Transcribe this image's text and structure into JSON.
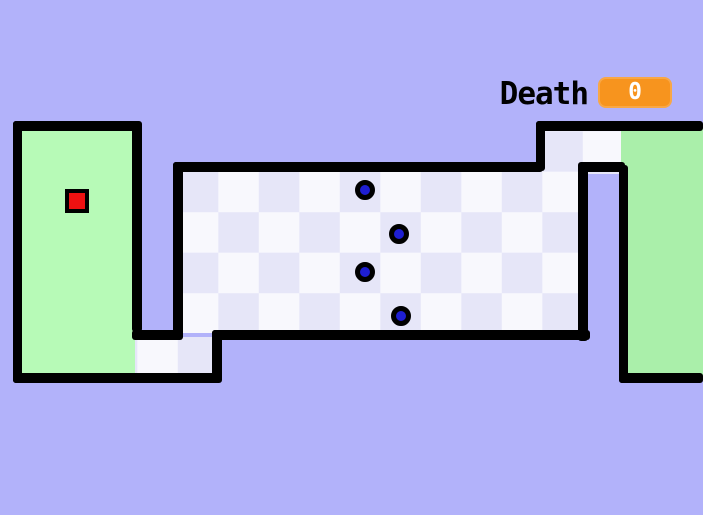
{
  "hud": {
    "death_label": "Death",
    "death_value": "0"
  },
  "colors": {
    "background": "#b2b2fa",
    "wall": "#000000",
    "start_green": "#b7fab7",
    "end_green": "#aaefaa",
    "checker_light": "#f8f8fd",
    "checker_dark": "#e6e6f8",
    "player_red": "#ee1111",
    "enemy_blue": "#1e1ed2",
    "badge_orange": "#f7941e"
  },
  "level": {
    "checker_grid": {
      "origin_x": 177.8,
      "origin_y": 171.7,
      "tile": 81
    },
    "floors": [
      {
        "name": "start-zone",
        "kind": "green",
        "color_key": "start_green",
        "x": 21,
        "y": 128,
        "w": 114,
        "h": 248
      },
      {
        "name": "end-zone",
        "kind": "green",
        "color_key": "end_green",
        "x": 621,
        "y": 128,
        "w": 82,
        "h": 248
      },
      {
        "name": "main-checker-area",
        "kind": "checker",
        "x": 181,
        "y": 169,
        "w": 400,
        "h": 164
      },
      {
        "name": "bottom-left-passage",
        "kind": "checker",
        "x": 135,
        "y": 337,
        "w": 80,
        "h": 39
      },
      {
        "name": "top-right-passage",
        "kind": "checker",
        "x": 543,
        "y": 129,
        "w": 78,
        "h": 45
      }
    ],
    "walls": [
      {
        "name": "wall-start-top",
        "x": 13,
        "y": 121,
        "w": 128,
        "h": 10
      },
      {
        "name": "wall-start-left",
        "x": 13,
        "y": 121,
        "w": 9,
        "h": 262
      },
      {
        "name": "wall-start-bottom",
        "x": 13,
        "y": 373,
        "w": 206,
        "h": 10
      },
      {
        "name": "wall-start-right",
        "x": 132,
        "y": 121,
        "w": 10,
        "h": 211
      },
      {
        "name": "wall-passage-ceiling",
        "x": 132,
        "y": 330,
        "w": 51,
        "h": 10
      },
      {
        "name": "wall-main-left",
        "x": 173,
        "y": 162,
        "w": 10,
        "h": 175
      },
      {
        "name": "wall-main-top",
        "x": 173,
        "y": 162,
        "w": 370,
        "h": 10
      },
      {
        "name": "wall-main-bottom",
        "x": 212,
        "y": 330,
        "w": 378,
        "h": 10
      },
      {
        "name": "wall-passage-right",
        "x": 212,
        "y": 330,
        "w": 10,
        "h": 53
      },
      {
        "name": "wall-main-right",
        "x": 578,
        "y": 165,
        "w": 10,
        "h": 176
      },
      {
        "name": "wall-exit-connector",
        "x": 536,
        "y": 121,
        "w": 9,
        "h": 50
      },
      {
        "name": "wall-exit-top",
        "x": 536,
        "y": 121,
        "w": 167,
        "h": 10
      },
      {
        "name": "wall-exit-bottom",
        "x": 578,
        "y": 162,
        "w": 47,
        "h": 10
      },
      {
        "name": "wall-end-left",
        "x": 619,
        "y": 165,
        "w": 9,
        "h": 218
      },
      {
        "name": "wall-end-bottom",
        "x": 619,
        "y": 373,
        "w": 84,
        "h": 10
      }
    ],
    "enemies": [
      {
        "cx": 365,
        "cy": 190
      },
      {
        "cx": 399,
        "cy": 234
      },
      {
        "cx": 365,
        "cy": 272
      },
      {
        "cx": 401,
        "cy": 316
      }
    ],
    "player": {
      "x": 65,
      "y": 189,
      "size": 24
    }
  }
}
